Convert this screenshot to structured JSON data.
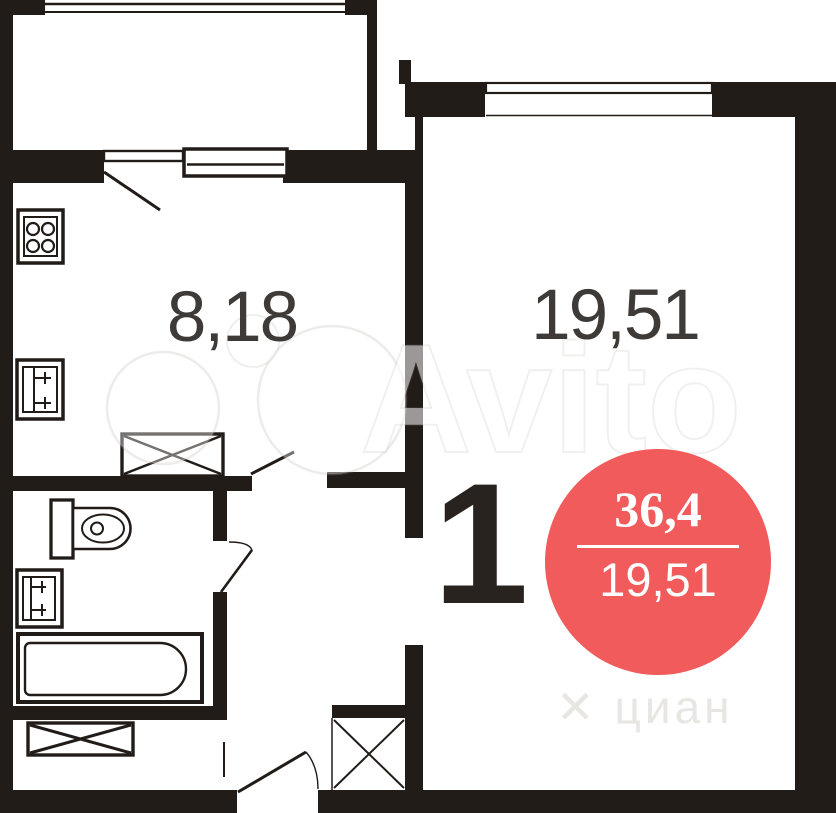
{
  "colors": {
    "wall": "#221c19",
    "badge_bg": "#f15b5b",
    "badge_text": "#ffffff",
    "area_label": "#3e3a38",
    "rooms_count": "#292320",
    "cian_watermark": "#e8e6e3"
  },
  "labels": {
    "kitchen_area": "8,18",
    "room_area": "19,51",
    "rooms_count": "1"
  },
  "badge": {
    "total_area": "36,4",
    "living_area": "19,51"
  },
  "watermarks": {
    "avito": "Avito",
    "cian_mark": "✕",
    "cian": "циан"
  },
  "icons": {
    "stove-icon": "4-burner stove square",
    "kitchen-sink-icon": "square sink with cross",
    "washbasin-icon": "square basin with cross",
    "toilet-icon": "toilet tank and bowl",
    "bathtub-icon": "bathtub with rounded end",
    "wardrobe-box-icon": "rectangle with X",
    "closet-cross-icon": "X in niche",
    "window-icon": "double line window",
    "door-leaf-icon": "door swing line"
  }
}
